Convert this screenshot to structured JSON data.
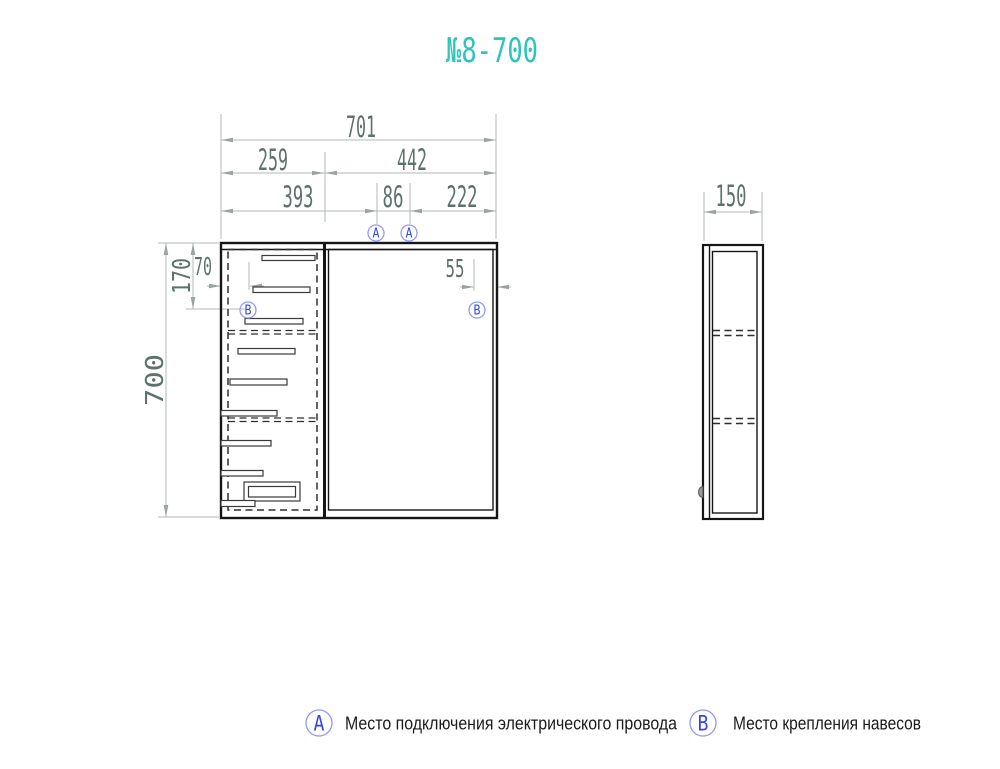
{
  "title": "№8-700",
  "colors": {
    "accent_teal": "#2bc5bd",
    "marker_blue": "#3548df",
    "dim_text": "#5e716d",
    "dim_line": "#b2b9b6",
    "outline": "#161616"
  },
  "front_view": {
    "dims": {
      "total_width": "701",
      "open_section_width": "259",
      "door_width": "442",
      "outlet_left_offset": "393",
      "outlet_span": "86",
      "outlet_right_offset": "222",
      "hinge_inset_left": "70",
      "hinge_top_offset": "170",
      "total_height": "700",
      "hinge_inset_right": "55"
    },
    "markers": {
      "a": "A",
      "b": "B"
    }
  },
  "side_view": {
    "dims": {
      "depth": "150"
    }
  },
  "legend": [
    {
      "symbol": "A",
      "label": "Место подключения электрического провода"
    },
    {
      "symbol": "B",
      "label": "Место крепления навесов"
    }
  ]
}
